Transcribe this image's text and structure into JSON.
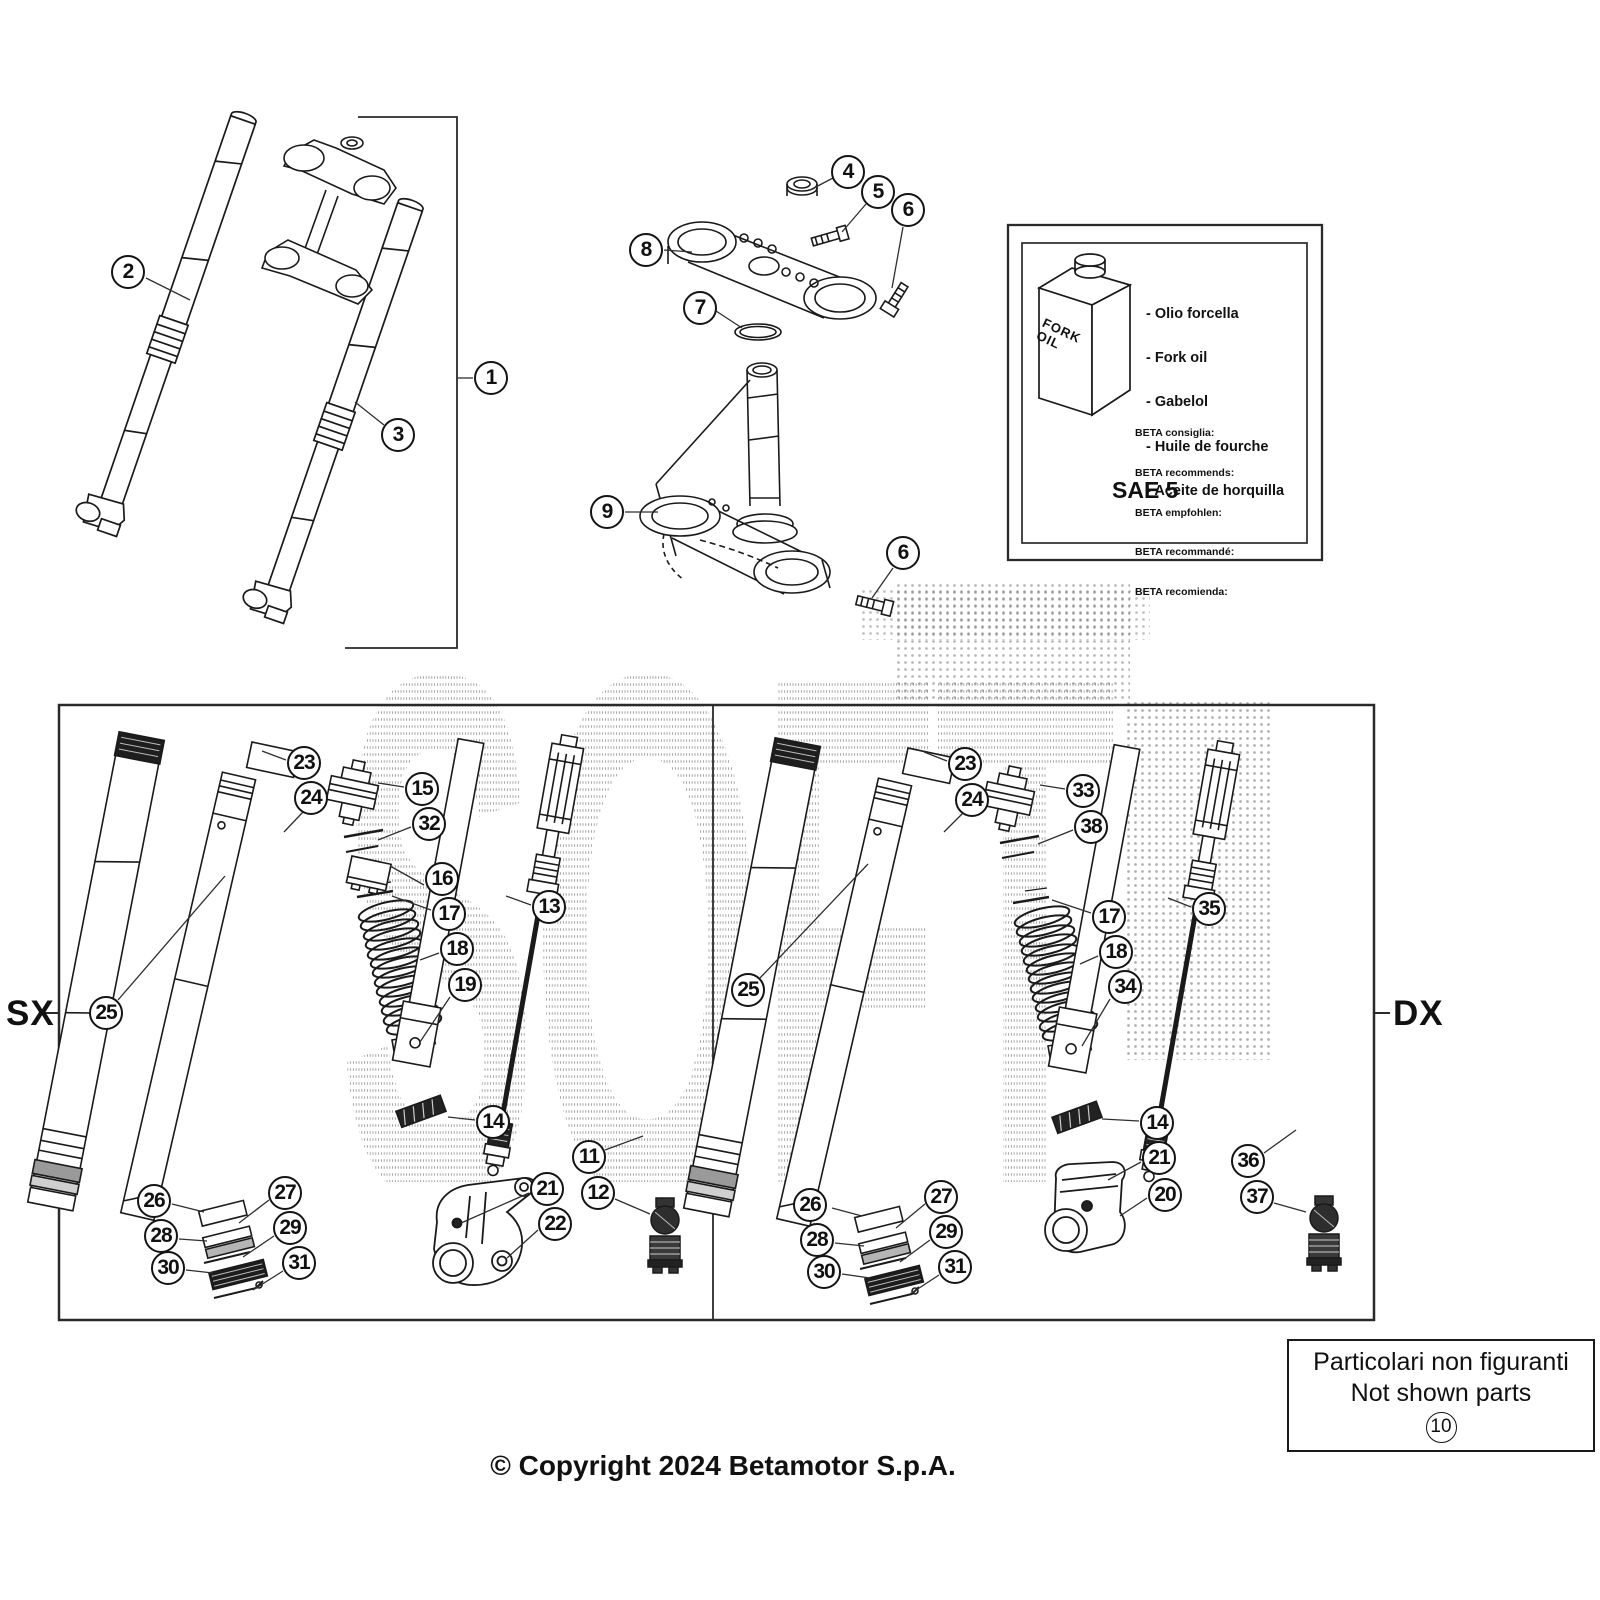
{
  "page": {
    "copyright": "© Copyright 2024 Betamotor S.p.A.",
    "side_label_left": "SX",
    "side_label_right": "DX",
    "watermark": "SOFT"
  },
  "oil_box": {
    "bottle_line1": "FORK",
    "bottle_line2": "OIL",
    "oil_names": [
      "- Olio forcella",
      "- Fork oil",
      "- Gabelol",
      "- Huile de fourche",
      "- Aceite de horquilla"
    ],
    "recommendations": [
      "BETA consiglia:",
      "BETA recommends:",
      "BETA empfohlen:",
      "BETA recommandé:",
      "BETA recomienda:"
    ],
    "grade": "SAE 5"
  },
  "not_shown": {
    "line1": "Particolari non figuranti",
    "line2": "Not shown parts",
    "callout": "10"
  },
  "callouts": [
    {
      "n": "1",
      "x": 491,
      "y": 378
    },
    {
      "n": "2",
      "x": 128,
      "y": 272
    },
    {
      "n": "3",
      "x": 398,
      "y": 435
    },
    {
      "n": "4",
      "x": 848,
      "y": 172
    },
    {
      "n": "5",
      "x": 878,
      "y": 192
    },
    {
      "n": "6",
      "x": 908,
      "y": 210
    },
    {
      "n": "8",
      "x": 646,
      "y": 250
    },
    {
      "n": "7",
      "x": 700,
      "y": 308
    },
    {
      "n": "9",
      "x": 607,
      "y": 512
    },
    {
      "n": "6",
      "x": 903,
      "y": 553
    },
    {
      "n": "23",
      "x": 304,
      "y": 763
    },
    {
      "n": "24",
      "x": 311,
      "y": 798
    },
    {
      "n": "15",
      "x": 422,
      "y": 789
    },
    {
      "n": "32",
      "x": 429,
      "y": 824
    },
    {
      "n": "16",
      "x": 442,
      "y": 879
    },
    {
      "n": "17",
      "x": 449,
      "y": 914
    },
    {
      "n": "18",
      "x": 457,
      "y": 949
    },
    {
      "n": "19",
      "x": 465,
      "y": 985
    },
    {
      "n": "13",
      "x": 549,
      "y": 907
    },
    {
      "n": "25",
      "x": 106,
      "y": 1013
    },
    {
      "n": "14",
      "x": 493,
      "y": 1122
    },
    {
      "n": "11",
      "x": 589,
      "y": 1157
    },
    {
      "n": "12",
      "x": 598,
      "y": 1193
    },
    {
      "n": "21",
      "x": 547,
      "y": 1189
    },
    {
      "n": "22",
      "x": 555,
      "y": 1224
    },
    {
      "n": "26",
      "x": 154,
      "y": 1201
    },
    {
      "n": "27",
      "x": 285,
      "y": 1193
    },
    {
      "n": "28",
      "x": 161,
      "y": 1236
    },
    {
      "n": "29",
      "x": 290,
      "y": 1228
    },
    {
      "n": "30",
      "x": 168,
      "y": 1268
    },
    {
      "n": "31",
      "x": 299,
      "y": 1263
    },
    {
      "n": "23",
      "x": 965,
      "y": 764
    },
    {
      "n": "24",
      "x": 972,
      "y": 800
    },
    {
      "n": "33",
      "x": 1083,
      "y": 791
    },
    {
      "n": "38",
      "x": 1091,
      "y": 827
    },
    {
      "n": "17",
      "x": 1109,
      "y": 917
    },
    {
      "n": "18",
      "x": 1116,
      "y": 952
    },
    {
      "n": "34",
      "x": 1125,
      "y": 987
    },
    {
      "n": "35",
      "x": 1209,
      "y": 909
    },
    {
      "n": "25",
      "x": 748,
      "y": 990
    },
    {
      "n": "14",
      "x": 1157,
      "y": 1123
    },
    {
      "n": "21",
      "x": 1159,
      "y": 1158
    },
    {
      "n": "20",
      "x": 1165,
      "y": 1195
    },
    {
      "n": "36",
      "x": 1248,
      "y": 1161
    },
    {
      "n": "37",
      "x": 1257,
      "y": 1197
    },
    {
      "n": "26",
      "x": 810,
      "y": 1205
    },
    {
      "n": "27",
      "x": 941,
      "y": 1197
    },
    {
      "n": "28",
      "x": 817,
      "y": 1240
    },
    {
      "n": "29",
      "x": 946,
      "y": 1232
    },
    {
      "n": "30",
      "x": 824,
      "y": 1272
    },
    {
      "n": "31",
      "x": 955,
      "y": 1267
    }
  ]
}
